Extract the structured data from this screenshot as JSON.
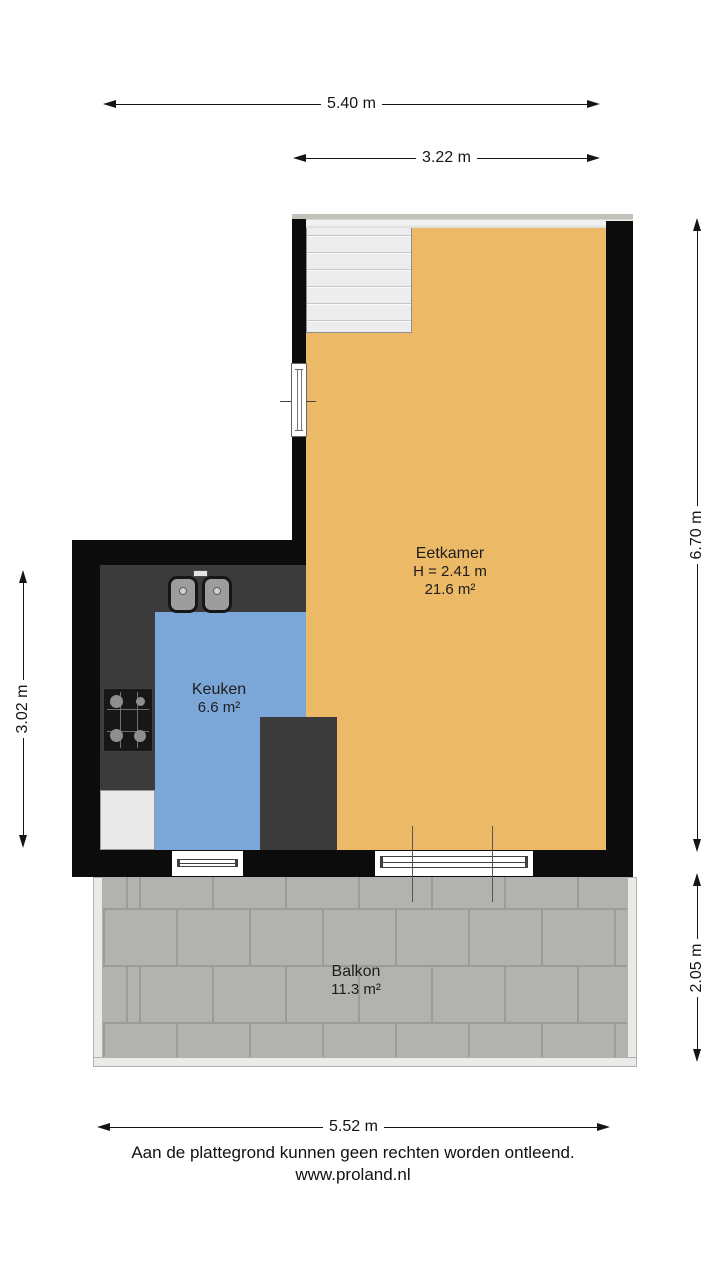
{
  "dimensions": {
    "top_total": "5.40 m",
    "top_upper_section": "3.22 m",
    "right_main": "6.70 m",
    "right_balcony": "2.05 m",
    "left_kitchen": "3.02 m",
    "bottom_total": "5.52 m"
  },
  "rooms": {
    "eetkamer": {
      "name": "Eetkamer",
      "ceiling_height": "H = 2.41 m",
      "area": "21.6 m²",
      "floor_color": "#ecb967"
    },
    "keuken": {
      "name": "Keuken",
      "area": "6.6 m²",
      "floor_color": "#7ba7d8"
    },
    "balkon": {
      "name": "Balkon",
      "area": "11.3 m²",
      "tile_color": "#b2b2af"
    }
  },
  "footer": {
    "disclaimer": "Aan de plattegrond kunnen geen rechten worden ontleend.",
    "website": "www.proland.nl"
  },
  "colors": {
    "wall": "#0c0c0c",
    "counter": "#3b3b3b"
  }
}
